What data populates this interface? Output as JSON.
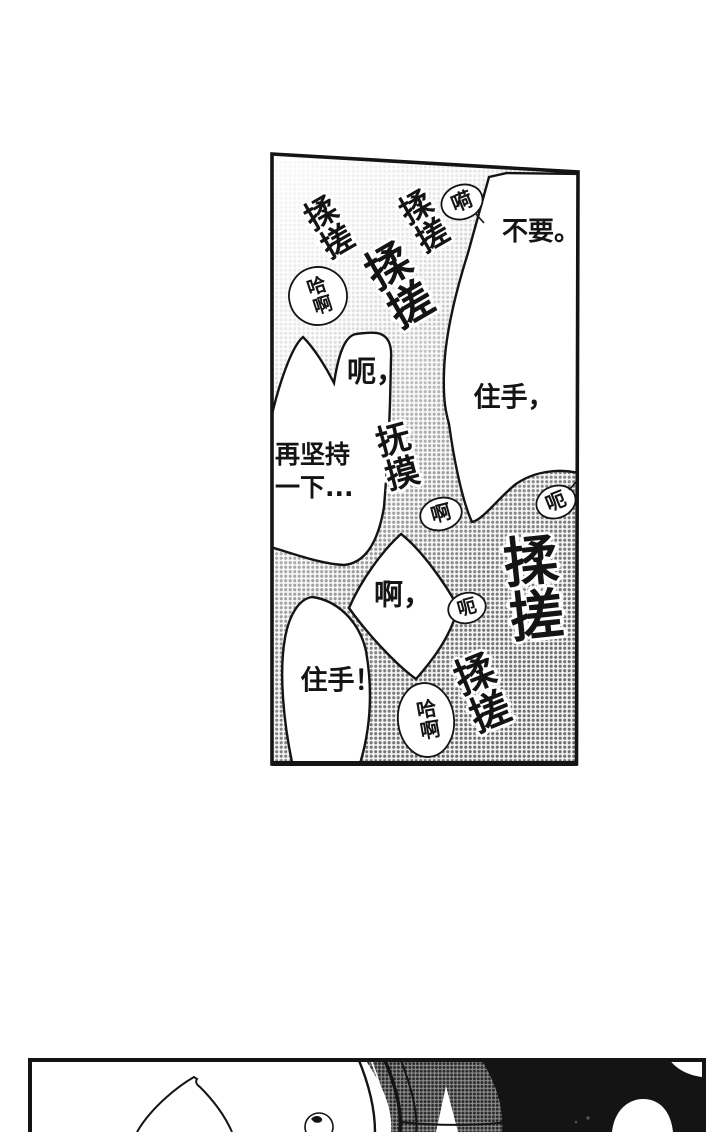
{
  "page": {
    "background": "#ffffff",
    "ink": "#141414",
    "halftone_dot": "#6f6f6f"
  },
  "panel_main": {
    "sfx": [
      {
        "text": "揉搓"
      },
      {
        "text": "揉搓"
      },
      {
        "text": "揉搓"
      },
      {
        "text": "抚摸"
      },
      {
        "text": "揉搓"
      },
      {
        "text": "揉搓"
      }
    ],
    "dialogue": [
      {
        "text": "不要。"
      },
      {
        "text": "呃，"
      },
      {
        "text": "住手，"
      },
      {
        "line1": "再坚持",
        "line2": "一下..."
      },
      {
        "text": "啊，"
      },
      {
        "text": "住手！"
      }
    ],
    "murmurs": [
      {
        "text": "嗬"
      },
      {
        "text": "哈啊"
      },
      {
        "text": "啊"
      },
      {
        "text": "呃"
      },
      {
        "text": "呃"
      },
      {
        "text": "哈啊"
      }
    ]
  },
  "panel_bottom": {}
}
